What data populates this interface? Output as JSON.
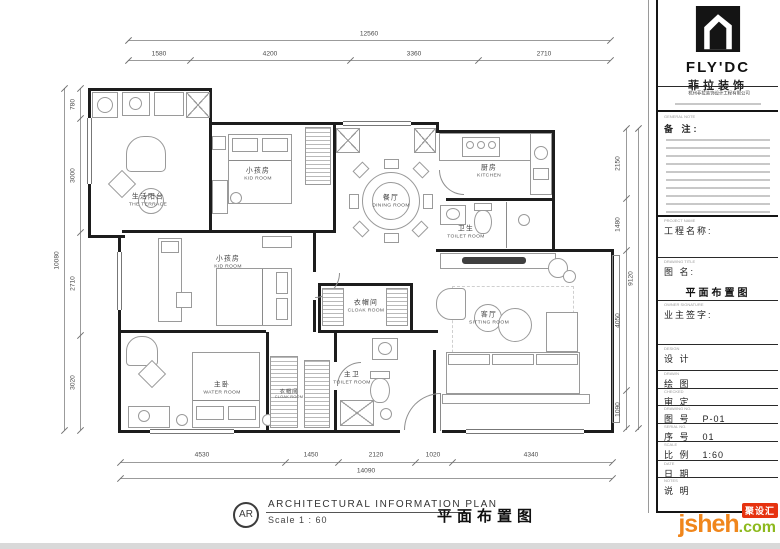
{
  "plan": {
    "rooms": [
      {
        "zh": "生活阳台",
        "en": "THE TERRACE"
      },
      {
        "zh": "小孩房",
        "en": "KID ROOM"
      },
      {
        "zh": "餐厅",
        "en": "DINING ROOM"
      },
      {
        "zh": "厨房",
        "en": "KITCHEN"
      },
      {
        "zh": "卫生",
        "en": "TOILET ROOM"
      },
      {
        "zh": "小孩房",
        "en": "KID ROOM"
      },
      {
        "zh": "衣帽间",
        "en": "CLOAK ROOM"
      },
      {
        "zh": "主卫",
        "en": "TOILET ROOM"
      },
      {
        "zh": "主卧",
        "en": "WATER ROOM"
      },
      {
        "zh": "衣帽间",
        "en": "CLOAK ROOM"
      },
      {
        "zh": "客厅",
        "en": "SITTING ROOM"
      }
    ],
    "dims": {
      "top_total": "12560",
      "top_segments": [
        "1580",
        "4200",
        "3360",
        "2710"
      ],
      "bottom_segments": [
        "4530",
        "1450",
        "2120",
        "1020",
        "4340"
      ],
      "bottom_total": "14090",
      "left_segments": [
        "780",
        "3000",
        "2710",
        "3020"
      ],
      "left_total": "10080",
      "right_segments": [
        "2150",
        "1480",
        "4050",
        "1090"
      ],
      "right_total": "9120"
    }
  },
  "titleblock": {
    "logo": {
      "brand": "FLY'DC",
      "brand_zh": "菲拉装饰"
    },
    "company_line": "杭州菲拉装饰设计工程有限公司",
    "general_note_tiny": "GENERAL NOTE",
    "note_label": "备 注:",
    "fields": [
      {
        "tiny": "PROJECT NAME",
        "label": "工程名称:",
        "value": ""
      },
      {
        "tiny": "DRAWING TITLE",
        "label": "图  名:",
        "value": "平面布置图"
      },
      {
        "tiny": "OWNER SIGNATURE",
        "label": "业主签字:",
        "value": ""
      },
      {
        "tiny": "DESIGN",
        "label": "设 计",
        "value": ""
      },
      {
        "tiny": "DRAWN",
        "label": "绘 图",
        "value": ""
      },
      {
        "tiny": "CHECKED",
        "label": "审 定",
        "value": ""
      },
      {
        "tiny": "DRAWING NO.",
        "label": "图 号",
        "value": "P-01"
      },
      {
        "tiny": "SERIAL NO.",
        "label": "序 号",
        "value": "01"
      },
      {
        "tiny": "SCALE",
        "label": "比 例",
        "value": "1:60"
      },
      {
        "tiny": "DATE",
        "label": "日 期",
        "value": ""
      },
      {
        "tiny": "NOTES",
        "label": "说 明",
        "value": ""
      }
    ]
  },
  "footer": {
    "badge": "AR",
    "title_en": "ARCHITECTURAL  INFORMATION  PLAN",
    "scale_text": "Scale 1 : 60",
    "title_zh": "平面布置图"
  },
  "watermark": {
    "text": "jsheh",
    "suffix": ".com",
    "badge": "聚设汇",
    "color_main": "#f0861c",
    "color_suffix": "#8db91e",
    "color_badge": "#e6320f"
  }
}
